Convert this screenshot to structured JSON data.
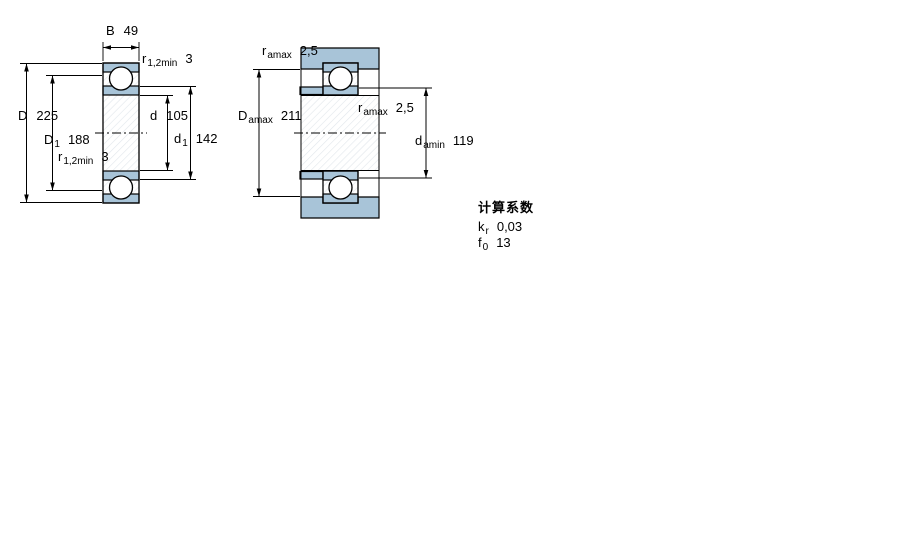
{
  "colors": {
    "fill_blue": "#a8c4d8",
    "line": "#000000",
    "hatch": "#e1e6eb",
    "background": "#ffffff"
  },
  "figure_left": {
    "name": "bearing cross-section",
    "labels": {
      "B": {
        "sym": "B",
        "sub": "",
        "value": "49"
      },
      "r_top": {
        "sym": "r",
        "sub": "1,2min",
        "value": "3"
      },
      "D": {
        "sym": "D",
        "sub": "",
        "value": "225"
      },
      "D1": {
        "sym": "D",
        "sub": "1",
        "value": "188"
      },
      "r_bot": {
        "sym": "r",
        "sub": "1,2min",
        "value": "3"
      },
      "d": {
        "sym": "d",
        "sub": "",
        "value": "105"
      },
      "d1": {
        "sym": "d",
        "sub": "1",
        "value": "142"
      }
    }
  },
  "figure_right": {
    "name": "abutment and fillet dimensions",
    "labels": {
      "ra_top": {
        "sym": "r",
        "sub": "amax",
        "value": "2,5"
      },
      "Da": {
        "sym": "D",
        "sub": "amax",
        "value": "211"
      },
      "ra_mid": {
        "sym": "r",
        "sub": "amax",
        "value": "2,5"
      },
      "da": {
        "sym": "d",
        "sub": "amin",
        "value": "119"
      }
    }
  },
  "calculation_factors": {
    "heading": "计算系数",
    "rows": [
      {
        "sym": "k",
        "sub": "r",
        "value": "0,03"
      },
      {
        "sym": "f",
        "sub": "0",
        "value": "13"
      }
    ]
  }
}
